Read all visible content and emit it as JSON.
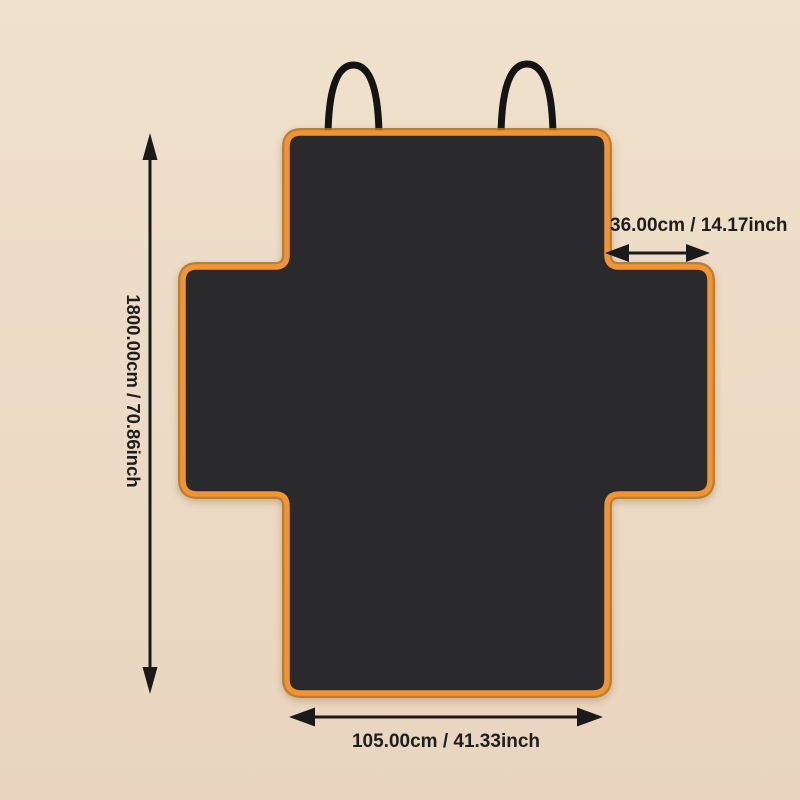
{
  "dimensions": {
    "height_label": "1800.00cm / 70.86inch",
    "top_width_label": "36.00cm / 14.17inch",
    "bottom_width_label": "105.00cm / 41.33inch"
  },
  "colors": {
    "bg_top": "#efe1cc",
    "bg_bottom": "#e9d5bf",
    "cover": "#2a2a2c",
    "trim": "#f09434",
    "trim_edge": "#b26d1d",
    "strap": "#141414",
    "arrow": "#1a1a1a",
    "text": "#1e1e1e"
  }
}
